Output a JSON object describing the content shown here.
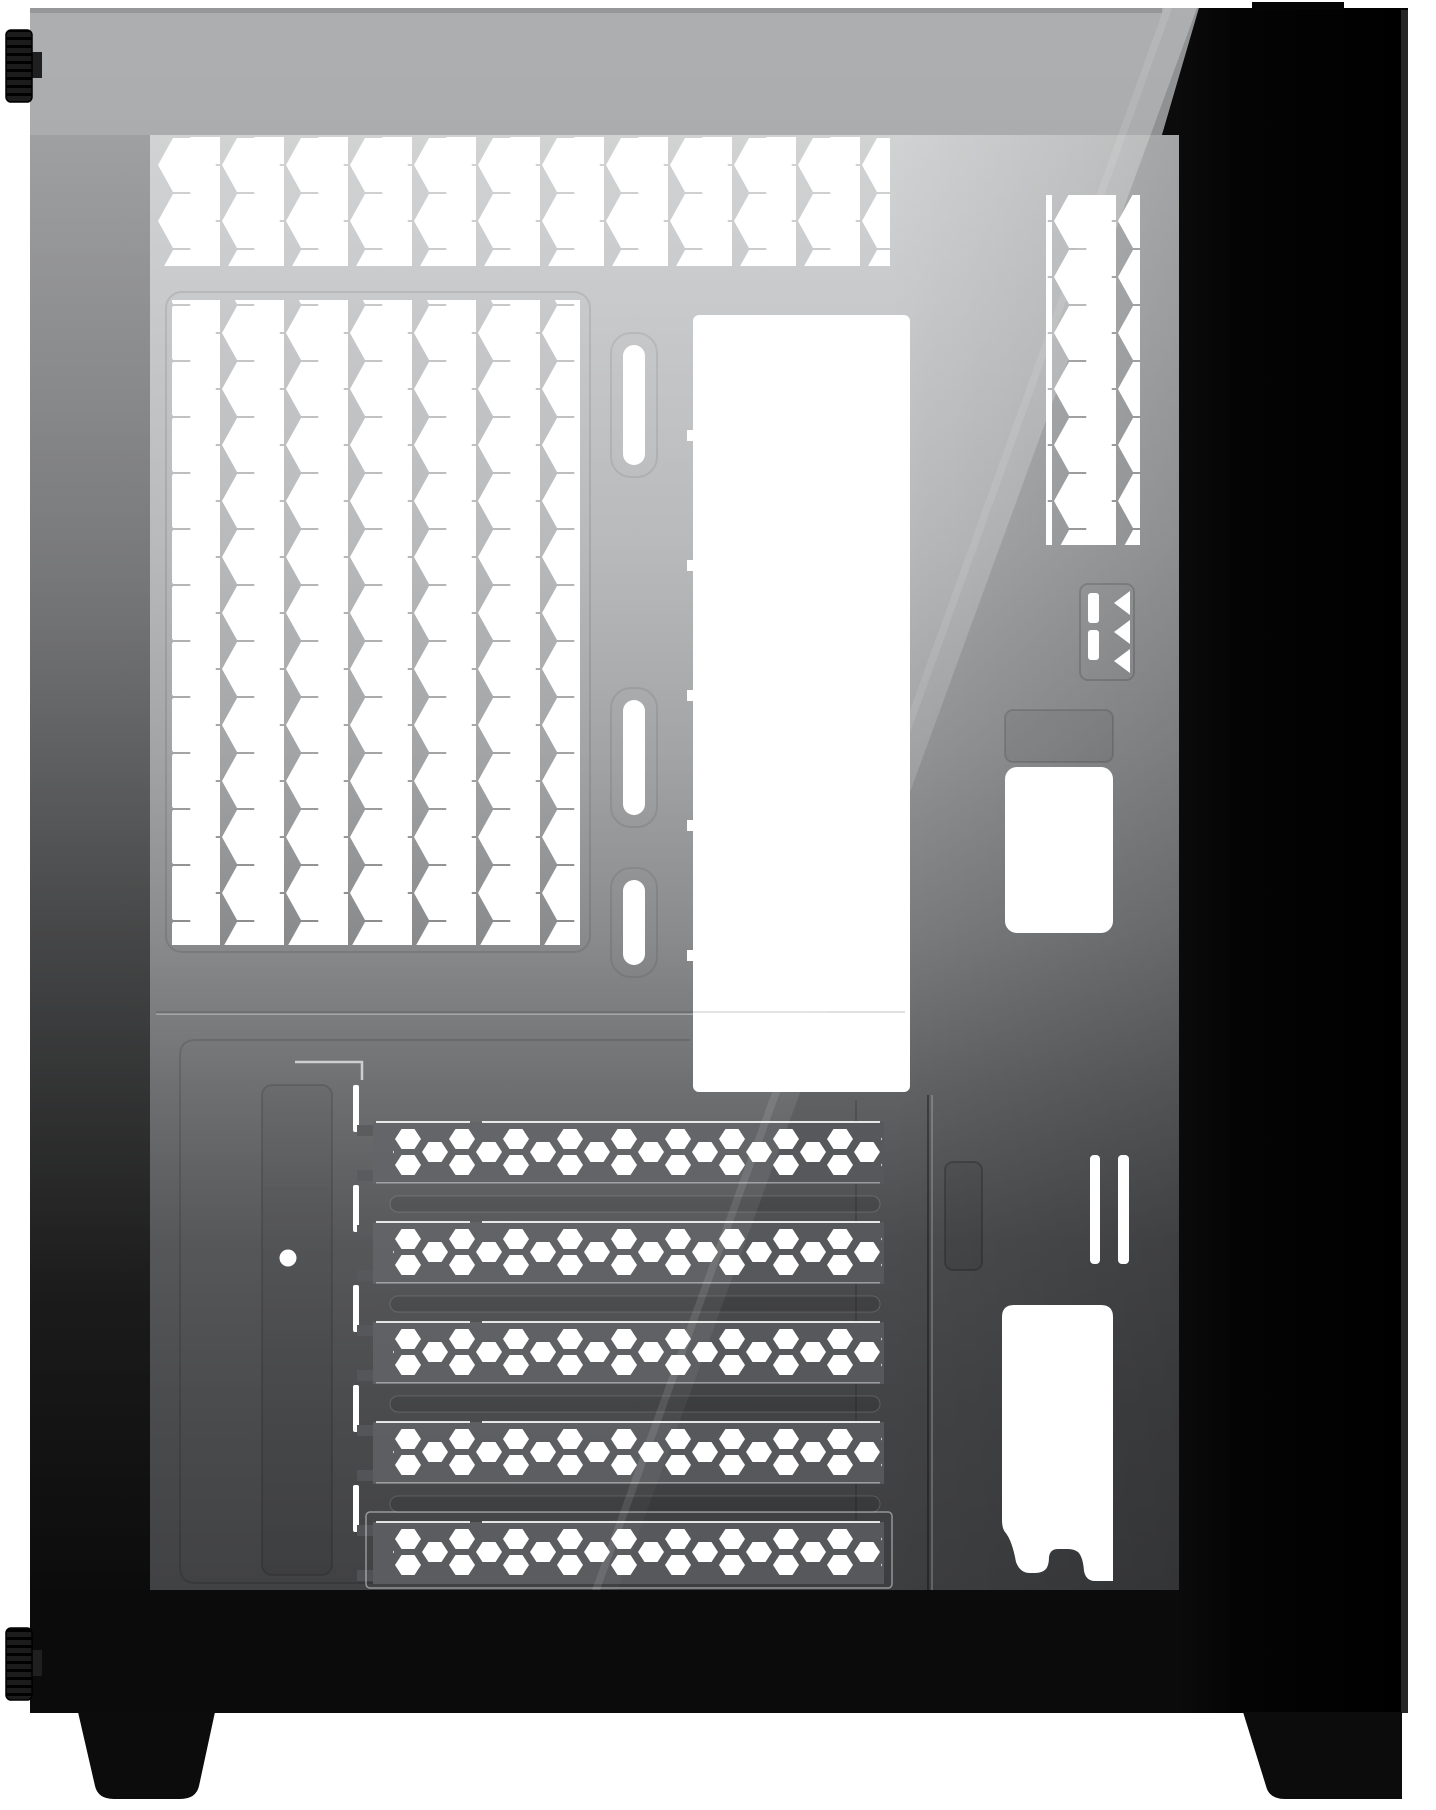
{
  "scene": {
    "type": "product-photo",
    "caption": "Black mid-tower PC case shown from the left side. A tempered glass side panel with a diagonal light reflection reveals the light-grey internal chassis: a hexagonal vent strip along the top, a large hexagonal vent panel for side fans, three vertical rubber-grommet cable slots, a tall white motherboard-tray cutout, five vented PCI slot covers, a PSU cutout and drive-tray cutouts near the glossy black front panel. Two knurled thumbscrews protrude from the rear edge and the case stands on two black feet.",
    "background_color": "#ffffff"
  },
  "product": {
    "kind": "PC tower case",
    "view": "left side profile",
    "panel": "tempered glass",
    "finish": "matte / glossy black"
  },
  "counts": {
    "pci_slot_covers": 5,
    "cable_grommet_slots": 3,
    "thumbscrews": 2,
    "case_feet": 2,
    "hex_vent_zones": 3,
    "front_drive_slits": 2,
    "alignment_arrows": 3
  },
  "colors": {
    "background": "#ffffff",
    "case_black": "#050505",
    "case_edge_sliver": "#262626",
    "top_frame_grey": "#8f9193",
    "interior_light": "#c6c8c9",
    "interior_dark": "#3f4042",
    "pci_bar_grey": "#56585b",
    "cutout_white": "#ffffff",
    "foot_black": "#0c0c0c"
  }
}
